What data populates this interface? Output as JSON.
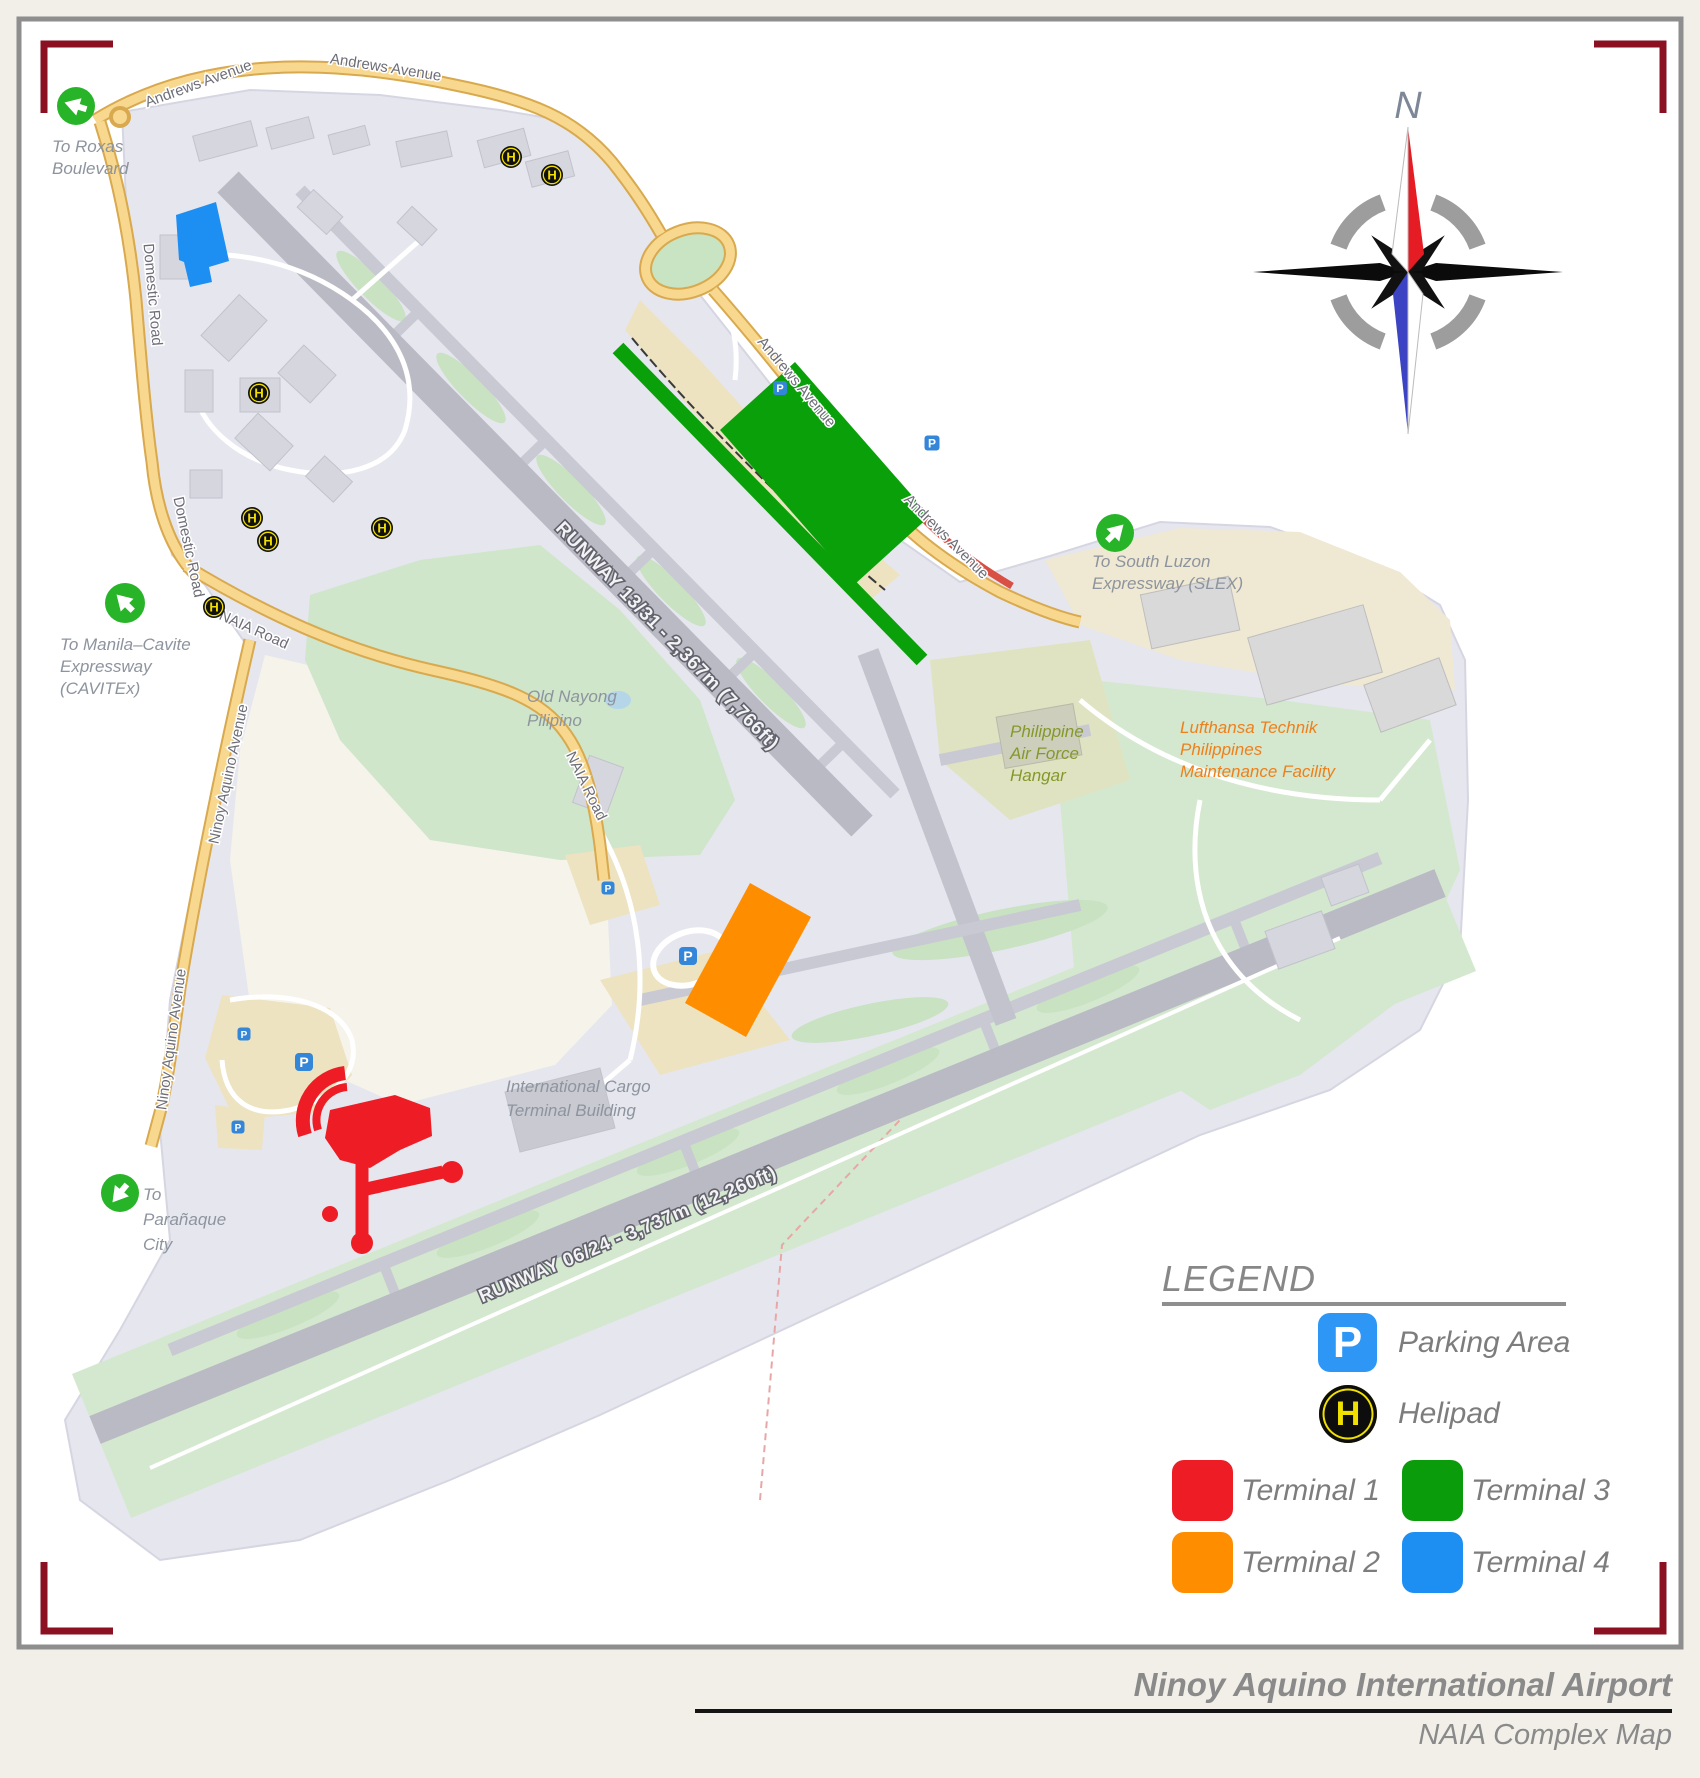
{
  "page": {
    "background": "#f2efe9",
    "frame_bracket_color": "#8A1022",
    "panel_border_color": "#8e8e8e"
  },
  "compass": {
    "north": "N"
  },
  "map": {
    "roads": {
      "andrews": "Andrews Avenue",
      "domestic": "Domestic Road",
      "naia": "NAIA Road",
      "ninoy_aquino": "Ninoy Aquino Avenue"
    },
    "runways": {
      "r13_31": "RUNWAY 13/31 - 2,367m (7,766ft)",
      "r06_24": "RUNWAY 06/24 - 3,737m (12,260ft)"
    },
    "places": {
      "old_nayong": {
        "line1": "Old Nayong",
        "line2": "Pilipino"
      },
      "paf_hangar": {
        "line1": "Philippine",
        "line2": "Air Force",
        "line3": "Hangar"
      },
      "lufthansa": {
        "line1": "Lufthansa Technik",
        "line2": "Philippines",
        "line3": "Maintenance Facility"
      },
      "cargo": {
        "line1": "International Cargo",
        "line2": "Terminal Building"
      }
    },
    "exits": {
      "roxas": {
        "line1": "To Roxas",
        "line2": "Boulevard"
      },
      "cavitex": {
        "line1": "To Manila–Cavite",
        "line2": "Expressway",
        "line3": "(CAVITEx)"
      },
      "slex": {
        "line1": "To South Luzon",
        "line2": "Expressway (SLEX)"
      },
      "paranaque": {
        "line1": "To",
        "line2": "Parañaque",
        "line3": "City"
      }
    },
    "markers": {
      "parking_letter": "P",
      "helipad_letter": "H"
    }
  },
  "legend": {
    "title": "LEGEND",
    "parking_label": "Parking Area",
    "helipad_label": "Helipad",
    "terminals": [
      {
        "label": "Terminal 1",
        "color": "#EE1C25"
      },
      {
        "label": "Terminal 2",
        "color": "#FF8D00"
      },
      {
        "label": "Terminal 3",
        "color": "#0A9C0A"
      },
      {
        "label": "Terminal 4",
        "color": "#1E8FF2"
      }
    ]
  },
  "footer": {
    "title": "Ninoy Aquino International Airport",
    "subtitle": "NAIA Complex Map"
  }
}
